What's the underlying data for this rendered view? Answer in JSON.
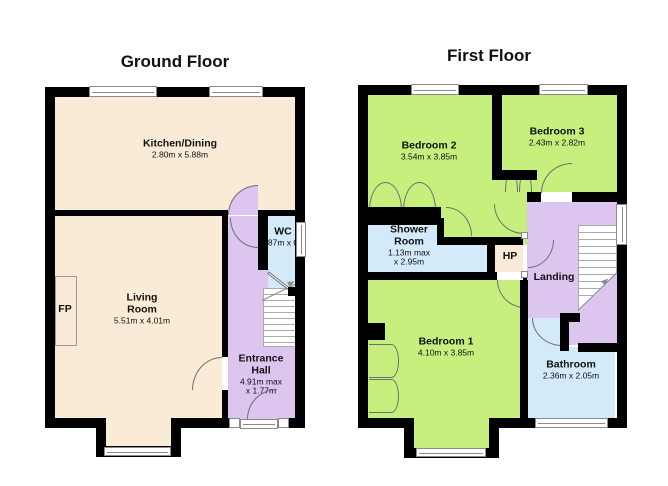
{
  "page": {
    "width": 668,
    "height": 486,
    "background": "#ffffff"
  },
  "colors": {
    "wall": "#000000",
    "cream": "#FAEBD7",
    "green": "#C6EF7E",
    "purple": "#DCC6F0",
    "blue": "#D2EAF9",
    "door_line": "#6f6f6f",
    "window_frame": "#8a8a8a",
    "stairs_line": "#aaaaaa",
    "stroke": "#999999",
    "text": "#111111"
  },
  "floors": [
    {
      "id": "ground",
      "title": "Ground Floor",
      "rooms": [
        {
          "id": "kitchen-dining",
          "x": 54,
          "y": 96,
          "w": 242,
          "h": 114,
          "fill": "cream"
        },
        {
          "id": "living-room",
          "x": 54,
          "y": 216,
          "w": 168,
          "h": 203,
          "fill": "cream"
        },
        {
          "id": "living-room-bay",
          "x": 106,
          "y": 419,
          "w": 65,
          "h": 28,
          "fill": "cream"
        },
        {
          "id": "entrance-hall",
          "x": 228,
          "y": 216,
          "w": 68,
          "h": 203,
          "fill": "purple"
        },
        {
          "id": "wc",
          "x": 268,
          "y": 215,
          "w": 29,
          "h": 75,
          "fill": "blue"
        },
        {
          "id": "fireplace",
          "x": 55,
          "y": 276,
          "w": 22,
          "h": 70,
          "fill": "cream",
          "stroke": true
        }
      ],
      "labels": [
        {
          "id": "kitchen-dining",
          "cx": 180,
          "cy": 149,
          "name_lines": [
            "Kitchen/Dining"
          ],
          "dim_lines": [
            "2.80m x 5.88m"
          ]
        },
        {
          "id": "living-room",
          "cx": 142,
          "cy": 309,
          "name_lines": [
            "Living",
            "Room"
          ],
          "dim_lines": [
            "5.51m x 4.01m"
          ]
        },
        {
          "id": "fireplace",
          "cx": 65,
          "cy": 310,
          "name_lines": [
            "FP"
          ],
          "dim_lines": []
        },
        {
          "id": "wc",
          "cx": 283,
          "cy": 237,
          "name_lines": [
            "WC"
          ],
          "dim_lines": [
            "1.87m x 0.7"
          ]
        },
        {
          "id": "entrance-hall",
          "cx": 261,
          "cy": 375,
          "name_lines": [
            "Entrance",
            "Hall"
          ],
          "dim_lines": [
            "4.91m max",
            "x 1.77m"
          ]
        }
      ],
      "walls": [
        [
          45,
          87,
          260,
          10
        ],
        [
          45,
          87,
          10,
          341
        ],
        [
          295,
          87,
          10,
          341
        ],
        [
          45,
          418,
          61,
          10
        ],
        [
          96,
          418,
          10,
          39
        ],
        [
          96,
          446,
          85,
          11
        ],
        [
          171,
          418,
          10,
          39
        ],
        [
          181,
          418,
          48,
          10
        ],
        [
          289,
          418,
          16,
          10
        ],
        [
          54,
          210,
          174,
          6
        ],
        [
          258,
          210,
          47,
          6
        ],
        [
          222,
          216,
          6,
          141
        ],
        [
          222,
          390,
          6,
          28
        ],
        [
          258,
          216,
          10,
          54
        ],
        [
          288,
          287,
          17,
          9
        ]
      ],
      "windows": [
        [
          89,
          86,
          68,
          11
        ],
        [
          209,
          86,
          54,
          11
        ],
        [
          296,
          222,
          10,
          35
        ],
        [
          104,
          447,
          67,
          9
        ],
        [
          240,
          419,
          38,
          10
        ]
      ],
      "jambs": [
        [
          229,
          418,
          11,
          10
        ],
        [
          278,
          418,
          11,
          10
        ]
      ],
      "doors": [
        {
          "x": 228,
          "y": 185,
          "w": 30,
          "h": 30,
          "q": "tl",
          "fill": "purple"
        },
        {
          "x": 230,
          "y": 218,
          "w": 28,
          "h": 30,
          "q": "bl"
        },
        {
          "x": 192,
          "y": 357,
          "w": 30,
          "h": 33,
          "q": "tl"
        },
        {
          "x": 247,
          "y": 389,
          "w": 30,
          "h": 30,
          "q": "tl"
        }
      ],
      "leafs": [
        {
          "x": 268,
          "y": 271,
          "len": 26,
          "angle": 38
        }
      ],
      "scallops": [],
      "stairs": {
        "x": 263,
        "y": 288,
        "w": 33,
        "h": 59,
        "tread_from": 294,
        "tread_step": 6,
        "tread_count": 9,
        "diag": {
          "x": 262,
          "y": 300,
          "len": 39,
          "angle": -26
        },
        "triangle": null
      },
      "arrows": [
        {
          "x": 288,
          "y": 280,
          "angle": -27
        }
      ]
    },
    {
      "id": "first",
      "title": "First Floor",
      "rooms": [
        {
          "id": "bedroom-2",
          "x": 367,
          "y": 95,
          "w": 125,
          "h": 112,
          "fill": "green"
        },
        {
          "id": "corridor",
          "x": 441,
          "y": 180,
          "w": 86,
          "h": 65,
          "fill": "green"
        },
        {
          "id": "bedroom-3",
          "x": 502,
          "y": 95,
          "w": 115,
          "h": 97,
          "fill": "green"
        },
        {
          "id": "bedroom-1",
          "x": 367,
          "y": 280,
          "w": 153,
          "h": 139,
          "fill": "green"
        },
        {
          "id": "bedroom-1-bay",
          "x": 414,
          "y": 419,
          "w": 76,
          "h": 29,
          "fill": "green"
        },
        {
          "id": "shower-room",
          "x": 367,
          "y": 225,
          "w": 70,
          "h": 47,
          "fill": "blue"
        },
        {
          "id": "shower-room-ext",
          "x": 437,
          "y": 245,
          "w": 50,
          "h": 27,
          "fill": "blue"
        },
        {
          "id": "hp",
          "x": 495,
          "y": 245,
          "w": 28,
          "h": 27,
          "fill": "cream"
        },
        {
          "id": "landing",
          "x": 527,
          "y": 202,
          "w": 90,
          "h": 143,
          "fill": "purple"
        },
        {
          "id": "bathroom",
          "x": 527,
          "y": 347,
          "w": 88,
          "h": 72,
          "fill": "blue"
        },
        {
          "id": "bathroom-vestibule",
          "x": 527,
          "y": 318,
          "w": 33,
          "h": 29,
          "fill": "blue"
        }
      ],
      "labels": [
        {
          "id": "bedroom-2",
          "cx": 429,
          "cy": 151,
          "name_lines": [
            "Bedroom 2"
          ],
          "dim_lines": [
            "3.54m x 3.85m"
          ]
        },
        {
          "id": "bedroom-3",
          "cx": 557,
          "cy": 137,
          "name_lines": [
            "Bedroom 3"
          ],
          "dim_lines": [
            "2.43m x 2.82m"
          ]
        },
        {
          "id": "shower-room",
          "cx": 409,
          "cy": 246,
          "name_lines": [
            "Shower",
            "Room"
          ],
          "dim_lines": [
            "1.13m max",
            "x 2.95m"
          ]
        },
        {
          "id": "hp",
          "cx": 510,
          "cy": 257,
          "name_lines": [
            "HP"
          ],
          "dim_lines": []
        },
        {
          "id": "landing",
          "cx": 554,
          "cy": 278,
          "name_lines": [
            "Landing"
          ],
          "dim_lines": []
        },
        {
          "id": "bedroom-1",
          "cx": 446,
          "cy": 347,
          "name_lines": [
            "Bedroom 1"
          ],
          "dim_lines": [
            "4.10m x 3.85m"
          ]
        },
        {
          "id": "bathroom",
          "cx": 571,
          "cy": 370,
          "name_lines": [
            "Bathroom"
          ],
          "dim_lines": [
            "2.36m x 2.05m"
          ]
        }
      ],
      "walls": [
        [
          358,
          85,
          269,
          10
        ],
        [
          358,
          85,
          10,
          343
        ],
        [
          617,
          85,
          10,
          343
        ],
        [
          358,
          418,
          56,
          10
        ],
        [
          404,
          418,
          10,
          40
        ],
        [
          404,
          448,
          95,
          10
        ],
        [
          489,
          418,
          10,
          40
        ],
        [
          499,
          418,
          37,
          10
        ],
        [
          607,
          418,
          20,
          10
        ],
        [
          492,
          85,
          10,
          95
        ],
        [
          492,
          170,
          45,
          10
        ],
        [
          527,
          192,
          14,
          10
        ],
        [
          572,
          192,
          45,
          10
        ],
        [
          358,
          207,
          83,
          18
        ],
        [
          437,
          218,
          7,
          27
        ],
        [
          437,
          237,
          86,
          8
        ],
        [
          487,
          237,
          8,
          43
        ],
        [
          358,
          272,
          139,
          8
        ],
        [
          523,
          272,
          4,
          8
        ],
        [
          520,
          280,
          8,
          142
        ],
        [
          560,
          313,
          20,
          9
        ],
        [
          560,
          313,
          9,
          38
        ],
        [
          578,
          343,
          39,
          9
        ],
        [
          367,
          323,
          18,
          17
        ]
      ],
      "windows": [
        [
          411,
          84,
          48,
          11
        ],
        [
          539,
          84,
          49,
          11
        ],
        [
          616,
          204,
          11,
          41
        ],
        [
          535,
          418,
          73,
          10
        ],
        [
          416,
          448,
          70,
          9
        ]
      ],
      "jambs": [
        [
          521,
          232,
          7,
          7
        ],
        [
          521,
          271,
          7,
          7
        ]
      ],
      "doors": [
        {
          "x": 541,
          "y": 163,
          "w": 31,
          "h": 30,
          "q": "tl"
        },
        {
          "x": 494,
          "y": 204,
          "w": 30,
          "h": 30,
          "q": "bl"
        },
        {
          "x": 446,
          "y": 207,
          "w": 26,
          "h": 29,
          "q": "tr"
        },
        {
          "x": 528,
          "y": 240,
          "w": 26,
          "h": 28,
          "q": "br"
        },
        {
          "x": 497,
          "y": 280,
          "w": 28,
          "h": 28,
          "q": "bl"
        },
        {
          "x": 532,
          "y": 318,
          "w": 30,
          "h": 28,
          "q": "bl"
        }
      ],
      "leafs": [],
      "scallops": [
        {
          "x": 369,
          "y": 182,
          "w": 33,
          "h": 28,
          "dir": "up"
        },
        {
          "x": 403,
          "y": 182,
          "w": 33,
          "h": 28,
          "dir": "up"
        },
        {
          "x": 505,
          "y": 170,
          "w": 13,
          "h": 22,
          "dir": "up"
        },
        {
          "x": 519,
          "y": 170,
          "w": 13,
          "h": 22,
          "dir": "up"
        },
        {
          "x": 369,
          "y": 344,
          "w": 30,
          "h": 34,
          "dir": "right"
        },
        {
          "x": 369,
          "y": 379,
          "w": 30,
          "h": 34,
          "dir": "right"
        }
      ],
      "stairs": {
        "x": 578,
        "y": 225,
        "w": 39,
        "h": 85,
        "tread_from": 232,
        "tread_step": 7,
        "tread_count": 10,
        "diag": {
          "x": 578,
          "y": 310,
          "len": 55,
          "angle": -44.3
        },
        "triangle": {
          "x": 578,
          "y": 272,
          "w": 39,
          "h": 38
        }
      },
      "arrows": [
        {
          "x": 602,
          "y": 278,
          "angle": -44
        }
      ]
    }
  ]
}
